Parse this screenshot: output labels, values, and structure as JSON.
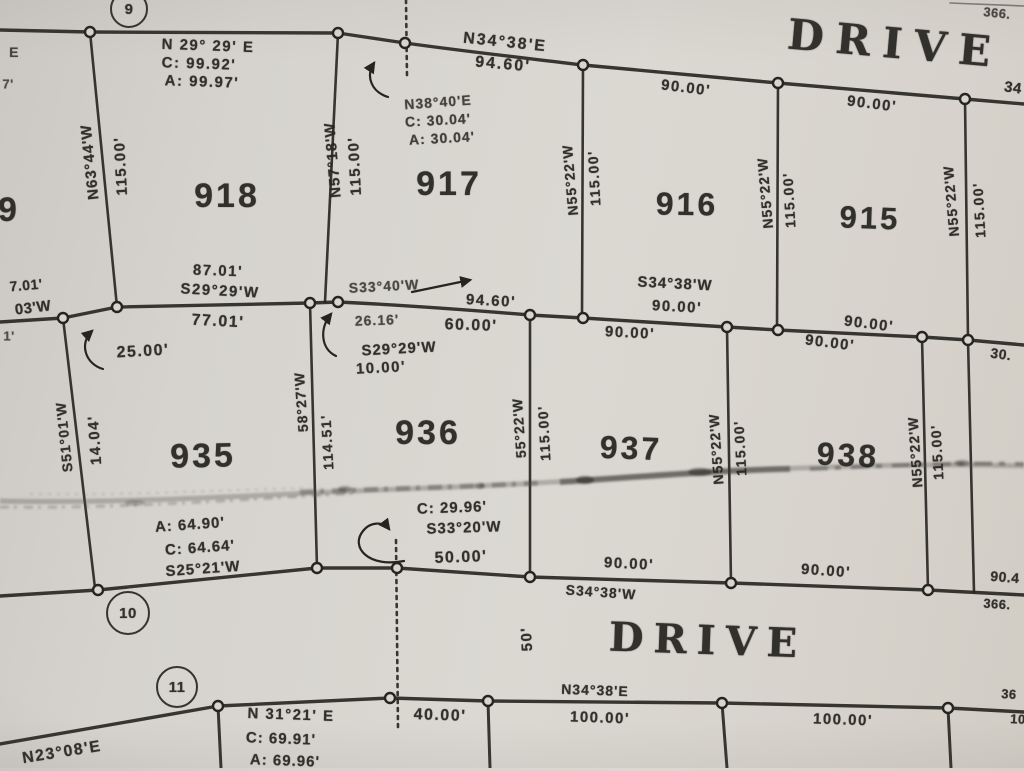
{
  "summary": {
    "sheet_type": "scanned subdivision plat",
    "street_name": "DRIVE",
    "street_width": "50'",
    "lots_upper_row": [
      "918",
      "917",
      "916",
      "915"
    ],
    "lots_lower_row": [
      "935",
      "936",
      "937",
      "938"
    ],
    "curve_point_markers": [
      "9",
      "10",
      "11"
    ]
  },
  "colors": {
    "paper": "#d8d5d0",
    "ink": "#26241f"
  },
  "map": {
    "labels": [
      {
        "n": "curve-point-9",
        "t": "9",
        "x": 129,
        "y": 9,
        "s": 15,
        "c": true,
        "d": 38
      },
      {
        "n": "bearing-n3438e-top",
        "t": "N34°38'E",
        "x": 505,
        "y": 43,
        "r": 6,
        "s": 16,
        "ls": 2
      },
      {
        "n": "dist-9460-top",
        "t": "94.60'",
        "x": 503,
        "y": 65,
        "r": 5,
        "s": 16,
        "ls": 2
      },
      {
        "n": "street-name-top",
        "t": "DRIVE",
        "x": 895,
        "y": 44,
        "r": 5,
        "s": 42,
        "f": "serif",
        "ls": 12
      },
      {
        "n": "frag-366-top",
        "t": "366.",
        "x": 997,
        "y": 13,
        "r": 6,
        "s": 13,
        "o": 0.8
      },
      {
        "n": "frag-34-top-right",
        "t": "34",
        "x": 1013,
        "y": 88,
        "r": 8,
        "s": 15
      },
      {
        "n": "lot918-curve-bearing",
        "t": "N 29° 29' E",
        "x": 208,
        "y": 46,
        "r": 2,
        "s": 15,
        "ls": 1.5
      },
      {
        "n": "lot918-curve-chord",
        "t": "C: 99.92'",
        "x": 199,
        "y": 64,
        "r": 2,
        "s": 15,
        "ls": 1.5
      },
      {
        "n": "lot918-curve-arc",
        "t": "A: 99.97'",
        "x": 202,
        "y": 82,
        "r": 2,
        "s": 15,
        "ls": 1.5
      },
      {
        "n": "lot918-west-bearing",
        "t": "N63°44'W",
        "x": 90,
        "y": 162,
        "r": -96,
        "s": 15,
        "ls": 1
      },
      {
        "n": "lot918-west-dist",
        "t": "115.00'",
        "x": 121,
        "y": 166,
        "r": -93,
        "s": 15,
        "ls": 1.5
      },
      {
        "n": "lot918-number",
        "t": "918",
        "x": 227,
        "y": 196,
        "s": 34,
        "ls": 3
      },
      {
        "n": "lot918-south-dist",
        "t": "87.01'",
        "x": 218,
        "y": 271,
        "r": 2,
        "s": 15,
        "ls": 1.5
      },
      {
        "n": "lot918-south-bearing",
        "t": "S29°29'W",
        "x": 220,
        "y": 291,
        "r": 3,
        "s": 15,
        "ls": 1.5
      },
      {
        "n": "lot917-west-bearing",
        "t": "N57°18'W",
        "x": 333,
        "y": 160,
        "r": -95,
        "s": 15,
        "ls": 1
      },
      {
        "n": "lot917-west-dist",
        "t": "115.00'",
        "x": 355,
        "y": 166,
        "r": -93,
        "s": 15,
        "ls": 1.5
      },
      {
        "n": "curve-bearing-n3840e",
        "t": "N38°40'E",
        "x": 438,
        "y": 102,
        "r": -4,
        "s": 14,
        "ls": 1,
        "o": 0.82
      },
      {
        "n": "curve-chord-3004",
        "t": "C: 30.04'",
        "x": 438,
        "y": 120,
        "r": -3,
        "s": 14,
        "ls": 1,
        "o": 0.85
      },
      {
        "n": "curve-arc-3004",
        "t": "A: 30.04'",
        "x": 442,
        "y": 138,
        "r": -3,
        "s": 14,
        "ls": 1,
        "o": 0.85
      },
      {
        "n": "lot917-number",
        "t": "917",
        "x": 449,
        "y": 184,
        "s": 34,
        "ls": 3
      },
      {
        "n": "lot917-east-bearing",
        "t": "N55°22'W",
        "x": 570,
        "y": 180,
        "r": -95,
        "s": 14,
        "ls": 1
      },
      {
        "n": "lot917-east-dist",
        "t": "115.00'",
        "x": 594,
        "y": 178,
        "r": -93,
        "s": 14,
        "ls": 1.5
      },
      {
        "n": "lot916-north-dist",
        "t": "90.00'",
        "x": 686,
        "y": 88,
        "r": 7,
        "s": 15,
        "ls": 1.5
      },
      {
        "n": "lot916-number",
        "t": "916",
        "x": 687,
        "y": 204,
        "r": 1,
        "s": 32,
        "ls": 3
      },
      {
        "n": "lot916-east-bearing",
        "t": "N55°22'W",
        "x": 765,
        "y": 193,
        "r": -95,
        "s": 14,
        "ls": 1
      },
      {
        "n": "lot916-east-dist",
        "t": "115.00'",
        "x": 789,
        "y": 200,
        "r": -93,
        "s": 14,
        "ls": 1.5
      },
      {
        "n": "lot915-north-dist",
        "t": "90.00'",
        "x": 872,
        "y": 104,
        "r": 7,
        "s": 15,
        "ls": 1.5
      },
      {
        "n": "lot915-number",
        "t": "915",
        "x": 870,
        "y": 218,
        "r": 2,
        "s": 31,
        "ls": 3
      },
      {
        "n": "lot915-east-bearing",
        "t": "N55°22'W",
        "x": 951,
        "y": 201,
        "r": -95,
        "s": 14,
        "ls": 1
      },
      {
        "n": "lot915-east-dist",
        "t": "115.00'",
        "x": 979,
        "y": 210,
        "r": -93,
        "s": 14,
        "ls": 1.5
      },
      {
        "n": "lot916-south-bearing",
        "t": "S34°38'W",
        "x": 675,
        "y": 284,
        "r": 3,
        "s": 15,
        "ls": 1
      },
      {
        "n": "lot916-south-dist",
        "t": "90.00'",
        "x": 677,
        "y": 307,
        "r": 3,
        "s": 15,
        "ls": 1.5
      },
      {
        "n": "bearing-s3340w",
        "t": "S33°40'W",
        "x": 384,
        "y": 286,
        "r": -3,
        "s": 14,
        "ls": 1,
        "o": 0.8
      },
      {
        "n": "dist-9460-mid",
        "t": "94.60'",
        "x": 491,
        "y": 301,
        "r": 3,
        "s": 15,
        "ls": 1.5
      },
      {
        "n": "lot935-north-dist",
        "t": "77.01'",
        "x": 218,
        "y": 322,
        "r": 3,
        "s": 16,
        "ls": 1.5
      },
      {
        "n": "dist-2616",
        "t": "26.16'",
        "x": 377,
        "y": 320,
        "r": -2,
        "s": 14,
        "ls": 1,
        "o": 0.8
      },
      {
        "n": "lot936-north-dist",
        "t": "60.00'",
        "x": 471,
        "y": 326,
        "r": 2,
        "s": 16,
        "ls": 1.5
      },
      {
        "n": "bearing-s2929w-936",
        "t": "S29°29'W",
        "x": 399,
        "y": 349,
        "r": -3,
        "s": 15,
        "ls": 1
      },
      {
        "n": "dist-1000",
        "t": "10.00'",
        "x": 381,
        "y": 368,
        "r": -3,
        "s": 15,
        "ls": 1.5
      },
      {
        "n": "dist-2500",
        "t": "25.00'",
        "x": 143,
        "y": 352,
        "r": -3,
        "s": 16,
        "ls": 1.5
      },
      {
        "n": "lot937-north-dist",
        "t": "90.00'",
        "x": 630,
        "y": 333,
        "r": 3,
        "s": 15,
        "ls": 1.5
      },
      {
        "n": "lot915-south-dist",
        "t": "90.00'",
        "x": 869,
        "y": 324,
        "r": 7,
        "s": 15,
        "ls": 1.5
      },
      {
        "n": "lot938-north-dist",
        "t": "90.00'",
        "x": 830,
        "y": 343,
        "r": 7,
        "s": 15,
        "ls": 1.5
      },
      {
        "n": "frag-30-right",
        "t": "30.",
        "x": 1001,
        "y": 354,
        "r": 8,
        "s": 14
      },
      {
        "n": "lot935-number",
        "t": "935",
        "x": 203,
        "y": 456,
        "r": -1,
        "s": 34,
        "ls": 3
      },
      {
        "n": "lot935-west-bearing",
        "t": "S51°01'W",
        "x": 64,
        "y": 437,
        "r": -96,
        "s": 14,
        "ls": 1
      },
      {
        "n": "lot935-west-dist",
        "t": "14.04'",
        "x": 95,
        "y": 440,
        "r": -94,
        "s": 15,
        "ls": 1.5
      },
      {
        "n": "lot936-west-bearing",
        "t": "58°27'W",
        "x": 301,
        "y": 402,
        "r": -94,
        "s": 14,
        "ls": 1
      },
      {
        "n": "lot936-west-dist",
        "t": "114.51'",
        "x": 327,
        "y": 442,
        "r": -93,
        "s": 14,
        "ls": 1.5
      },
      {
        "n": "lot936-number",
        "t": "936",
        "x": 428,
        "y": 433,
        "s": 34,
        "ls": 3
      },
      {
        "n": "lot937-west-bearing",
        "t": "55°22'W",
        "x": 519,
        "y": 428,
        "r": -94,
        "s": 14,
        "ls": 1
      },
      {
        "n": "lot937-west-dist",
        "t": "115.00'",
        "x": 544,
        "y": 433,
        "r": -93,
        "s": 14,
        "ls": 1.5
      },
      {
        "n": "lot937-number",
        "t": "937",
        "x": 631,
        "y": 448,
        "r": 2,
        "s": 32,
        "ls": 3
      },
      {
        "n": "lot937-east-bearing",
        "t": "N55°22'W",
        "x": 716,
        "y": 449,
        "r": -94,
        "s": 14,
        "ls": 1
      },
      {
        "n": "lot937-east-dist",
        "t": "115.00'",
        "x": 740,
        "y": 448,
        "r": -93,
        "s": 14,
        "ls": 1.5
      },
      {
        "n": "lot938-number",
        "t": "938",
        "x": 848,
        "y": 455,
        "r": 3,
        "s": 32,
        "ls": 3
      },
      {
        "n": "lot938-east-bearing",
        "t": "N55°22'W",
        "x": 915,
        "y": 452,
        "r": -94,
        "s": 14,
        "ls": 1
      },
      {
        "n": "lot938-east-dist",
        "t": "115.00'",
        "x": 937,
        "y": 452,
        "r": -93,
        "s": 14,
        "ls": 1.5
      },
      {
        "n": "lot935-curve-arc",
        "t": "A: 64.90'",
        "x": 190,
        "y": 525,
        "r": -4,
        "s": 15,
        "ls": 1
      },
      {
        "n": "lot935-curve-chord",
        "t": "C: 64.64'",
        "x": 200,
        "y": 548,
        "r": -4,
        "s": 15,
        "ls": 1
      },
      {
        "n": "lot935-curve-bearing",
        "t": "S25°21'W",
        "x": 203,
        "y": 569,
        "r": -4,
        "s": 15,
        "ls": 1
      },
      {
        "n": "curve-chord-2996",
        "t": "C: 29.96'",
        "x": 452,
        "y": 508,
        "r": -2,
        "s": 15,
        "ls": 1
      },
      {
        "n": "curve-bearing-s3320w",
        "t": "S33°20'W",
        "x": 464,
        "y": 528,
        "r": -2,
        "s": 15,
        "ls": 1
      },
      {
        "n": "lot936-south-dist",
        "t": "50.00'",
        "x": 461,
        "y": 558,
        "r": -2,
        "s": 16,
        "ls": 1.5
      },
      {
        "n": "lot937-south-dist",
        "t": "90.00'",
        "x": 629,
        "y": 564,
        "r": 3,
        "s": 15,
        "ls": 1.5
      },
      {
        "n": "bearing-s3438w-lower",
        "t": "S34°38'W",
        "x": 601,
        "y": 592,
        "r": 4,
        "s": 14,
        "ls": 1
      },
      {
        "n": "lot938-south-dist",
        "t": "90.00'",
        "x": 826,
        "y": 571,
        "r": 4,
        "s": 15,
        "ls": 1.5
      },
      {
        "n": "frag-904-right",
        "t": "90.4",
        "x": 1005,
        "y": 577,
        "r": 5,
        "s": 14
      },
      {
        "n": "frag-366-lower",
        "t": "366.",
        "x": 997,
        "y": 604,
        "r": 4,
        "s": 13
      },
      {
        "n": "curve-point-10",
        "t": "10",
        "x": 128,
        "y": 613,
        "s": 15,
        "c": true,
        "d": 44
      },
      {
        "n": "curve-point-11",
        "t": "11",
        "x": 177,
        "y": 687,
        "s": 15,
        "c": true,
        "d": 42
      },
      {
        "n": "street-width-50",
        "t": "50'",
        "x": 527,
        "y": 639,
        "r": -93,
        "s": 15,
        "ls": 1.5
      },
      {
        "n": "street-name-bottom",
        "t": "DRIVE",
        "x": 708,
        "y": 641,
        "r": 2,
        "s": 40,
        "f": "serif",
        "ls": 10
      },
      {
        "n": "bearing-n3438e-bottom",
        "t": "N34°38'E",
        "x": 595,
        "y": 690,
        "r": 2,
        "s": 14,
        "ls": 1
      },
      {
        "n": "bearing-n2308e",
        "t": "N23°08'E",
        "x": 62,
        "y": 753,
        "r": -9,
        "s": 16,
        "ls": 1.5
      },
      {
        "n": "lot-curve-n3121e",
        "t": "N 31°21' E",
        "x": 291,
        "y": 715,
        "r": 2,
        "s": 15,
        "ls": 1.5
      },
      {
        "n": "lot-curve-c6991",
        "t": "C: 69.91'",
        "x": 281,
        "y": 739,
        "r": 2,
        "s": 15,
        "ls": 1
      },
      {
        "n": "lot-curve-a6996",
        "t": "A: 69.96'",
        "x": 285,
        "y": 761,
        "r": 2,
        "s": 15,
        "ls": 1
      },
      {
        "n": "dist-4000-bottom",
        "t": "40.00'",
        "x": 440,
        "y": 716,
        "r": 2,
        "s": 16,
        "ls": 1.5
      },
      {
        "n": "dist-10000-a",
        "t": "100.00'",
        "x": 600,
        "y": 718,
        "r": 2,
        "s": 15,
        "ls": 1.5
      },
      {
        "n": "dist-10000-b",
        "t": "100.00'",
        "x": 843,
        "y": 720,
        "r": 2,
        "s": 15,
        "ls": 1.5
      },
      {
        "n": "frag-36-bottom-right",
        "t": "36",
        "x": 1009,
        "y": 694,
        "r": 4,
        "s": 13
      },
      {
        "n": "frag-10-bottom-right",
        "t": "10",
        "x": 1018,
        "y": 719,
        "r": 3,
        "s": 13
      },
      {
        "n": "frag-e-left",
        "t": "E",
        "x": 14,
        "y": 52,
        "s": 14,
        "o": 0.8
      },
      {
        "n": "frag-7-left",
        "t": "7'",
        "x": 8,
        "y": 84,
        "s": 13,
        "o": 0.75
      },
      {
        "n": "lot919-number-frag",
        "t": "9",
        "x": 9,
        "y": 210,
        "s": 34,
        "ls": 3
      },
      {
        "n": "frag-701-left",
        "t": "7.01'",
        "x": 26,
        "y": 285,
        "r": -5,
        "s": 14
      },
      {
        "n": "frag-03w-left",
        "t": "03'W",
        "x": 33,
        "y": 308,
        "r": -7,
        "s": 15
      },
      {
        "n": "frag-1-left",
        "t": "1'",
        "x": 9,
        "y": 336,
        "s": 13,
        "o": 0.75
      }
    ]
  }
}
